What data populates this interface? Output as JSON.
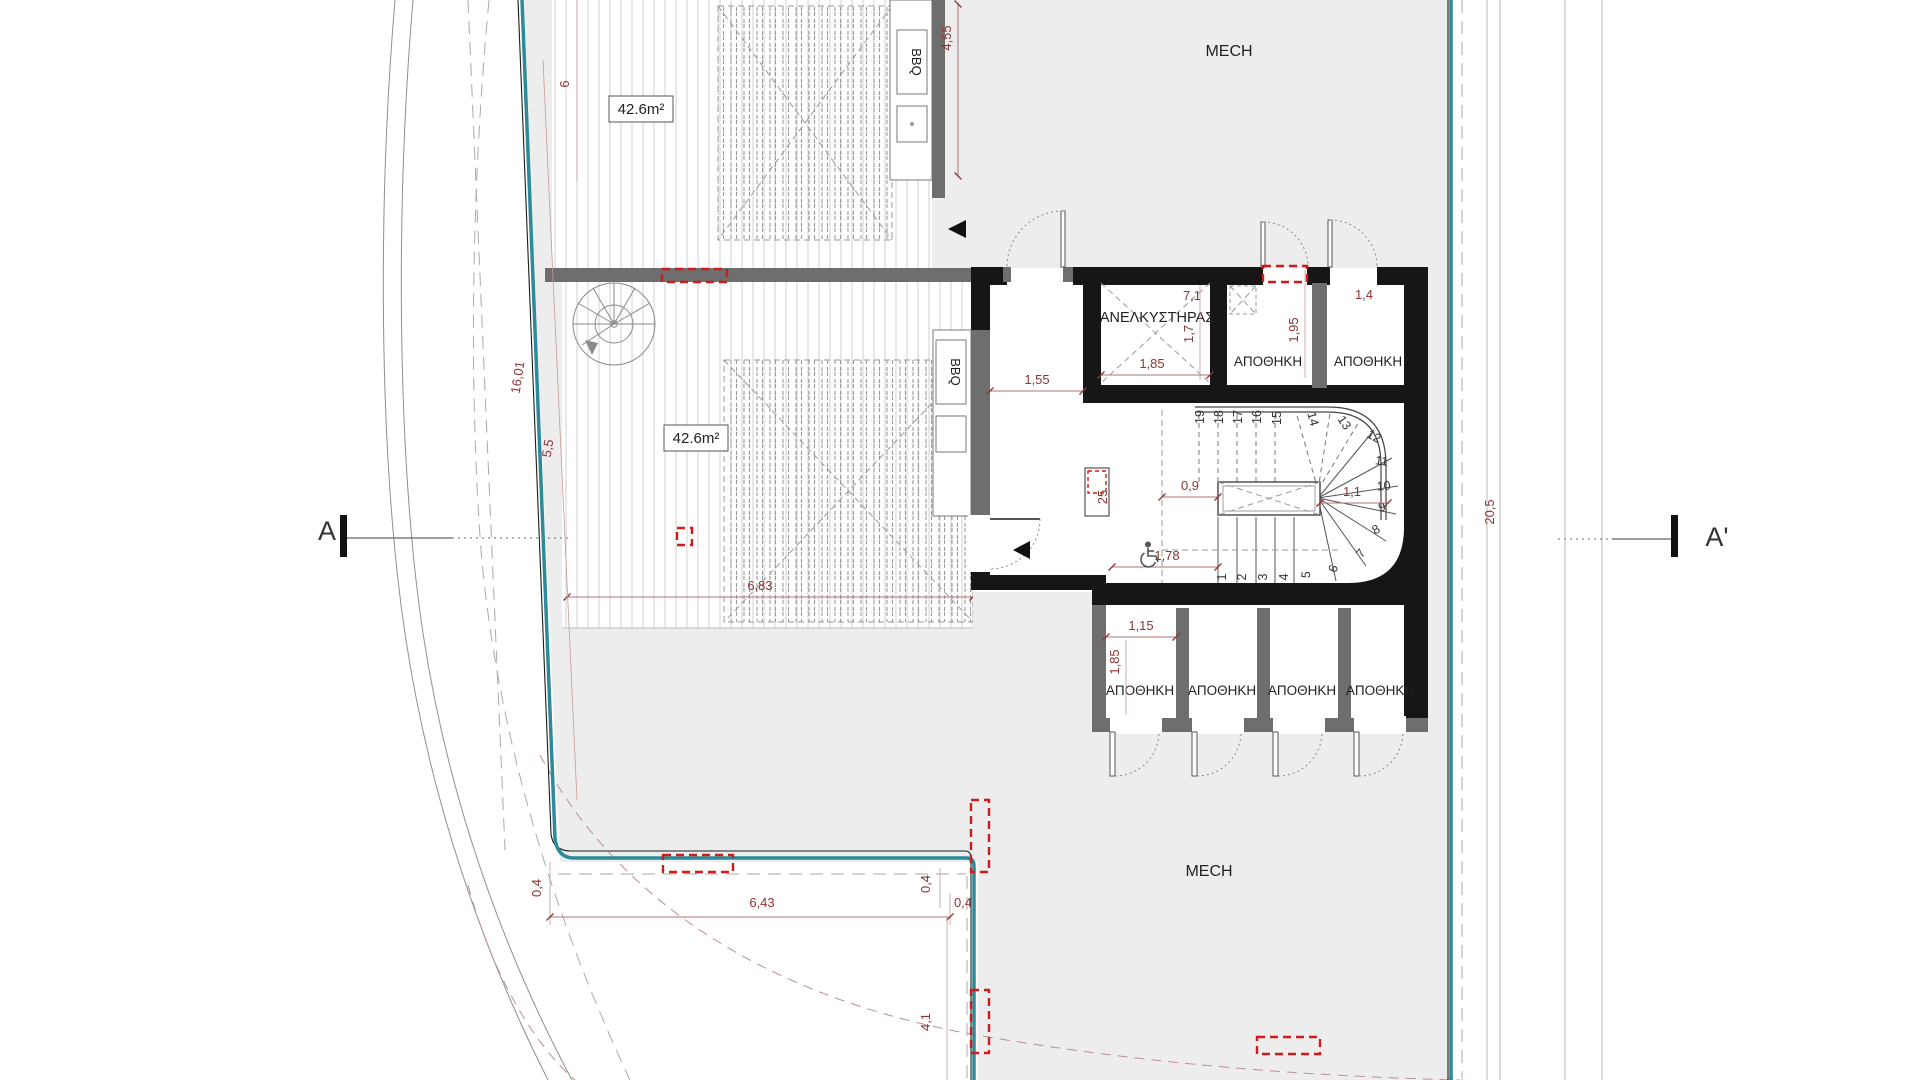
{
  "site": {
    "mech_top": "MECH",
    "mech_bottom": "MECH"
  },
  "terraces": {
    "top": {
      "area": "42.6m²",
      "bbq": "BBQ",
      "dim_height": "4,55",
      "dim_pergola": "6"
    },
    "middle": {
      "area": "42.6m²",
      "bbq": "BBQ",
      "dim_width": "6,83",
      "dim_boundary": "16,01",
      "dim_boundary2": "5,5"
    }
  },
  "core": {
    "elevator": {
      "label": "ΑΝΕΛΚΥΣΤΗΡΑΣ",
      "dim_w": "1,85",
      "dim_h": "1,7",
      "dim_top": "7,1"
    },
    "storages_top": {
      "label1": "ΑΠΟΘΗΚΗ",
      "label2": "ΑΠΟΘΗΚΗ",
      "dim_h": "1,95",
      "dim_w": "1,4"
    },
    "vestibule": {
      "dim_w": "1,55",
      "dim_shaft": "25"
    },
    "stairs": {
      "numbers": [
        "1",
        "2",
        "3",
        "4",
        "5",
        "6",
        "7",
        "8",
        "9",
        "10",
        "11",
        "12",
        "13",
        "14",
        "15",
        "16",
        "17",
        "18",
        "19"
      ],
      "dim_top": "0,9",
      "dim_right": "1,1",
      "dim_bottom": "1,78"
    },
    "storages_bottom": {
      "labels": [
        "ΑΠΟΘΗΚΗ",
        "ΑΠΟΘΗΚΗ",
        "ΑΠΟΘΗΚΗ",
        "ΑΠΟΘΗΚΗ"
      ],
      "dim_w": "1,15",
      "dim_h": "1,85"
    }
  },
  "dimensions": {
    "site_right": "20,5",
    "bottom_width": "6,43",
    "bottom_offset_left": "0,4",
    "bottom_offset_v": "0,4",
    "bottom_offset_right": "0,4",
    "bottom_right_height": "4,1"
  },
  "sections": {
    "a": "A",
    "a_prime": "A'"
  },
  "colors": {
    "boundary_teal": "#2d8a99",
    "red_dashed": "#cf1b1b",
    "dimension": "#8e3434",
    "wall": "#161616",
    "gray_wall": "#6e6e6e",
    "site_fill": "#ededed"
  }
}
